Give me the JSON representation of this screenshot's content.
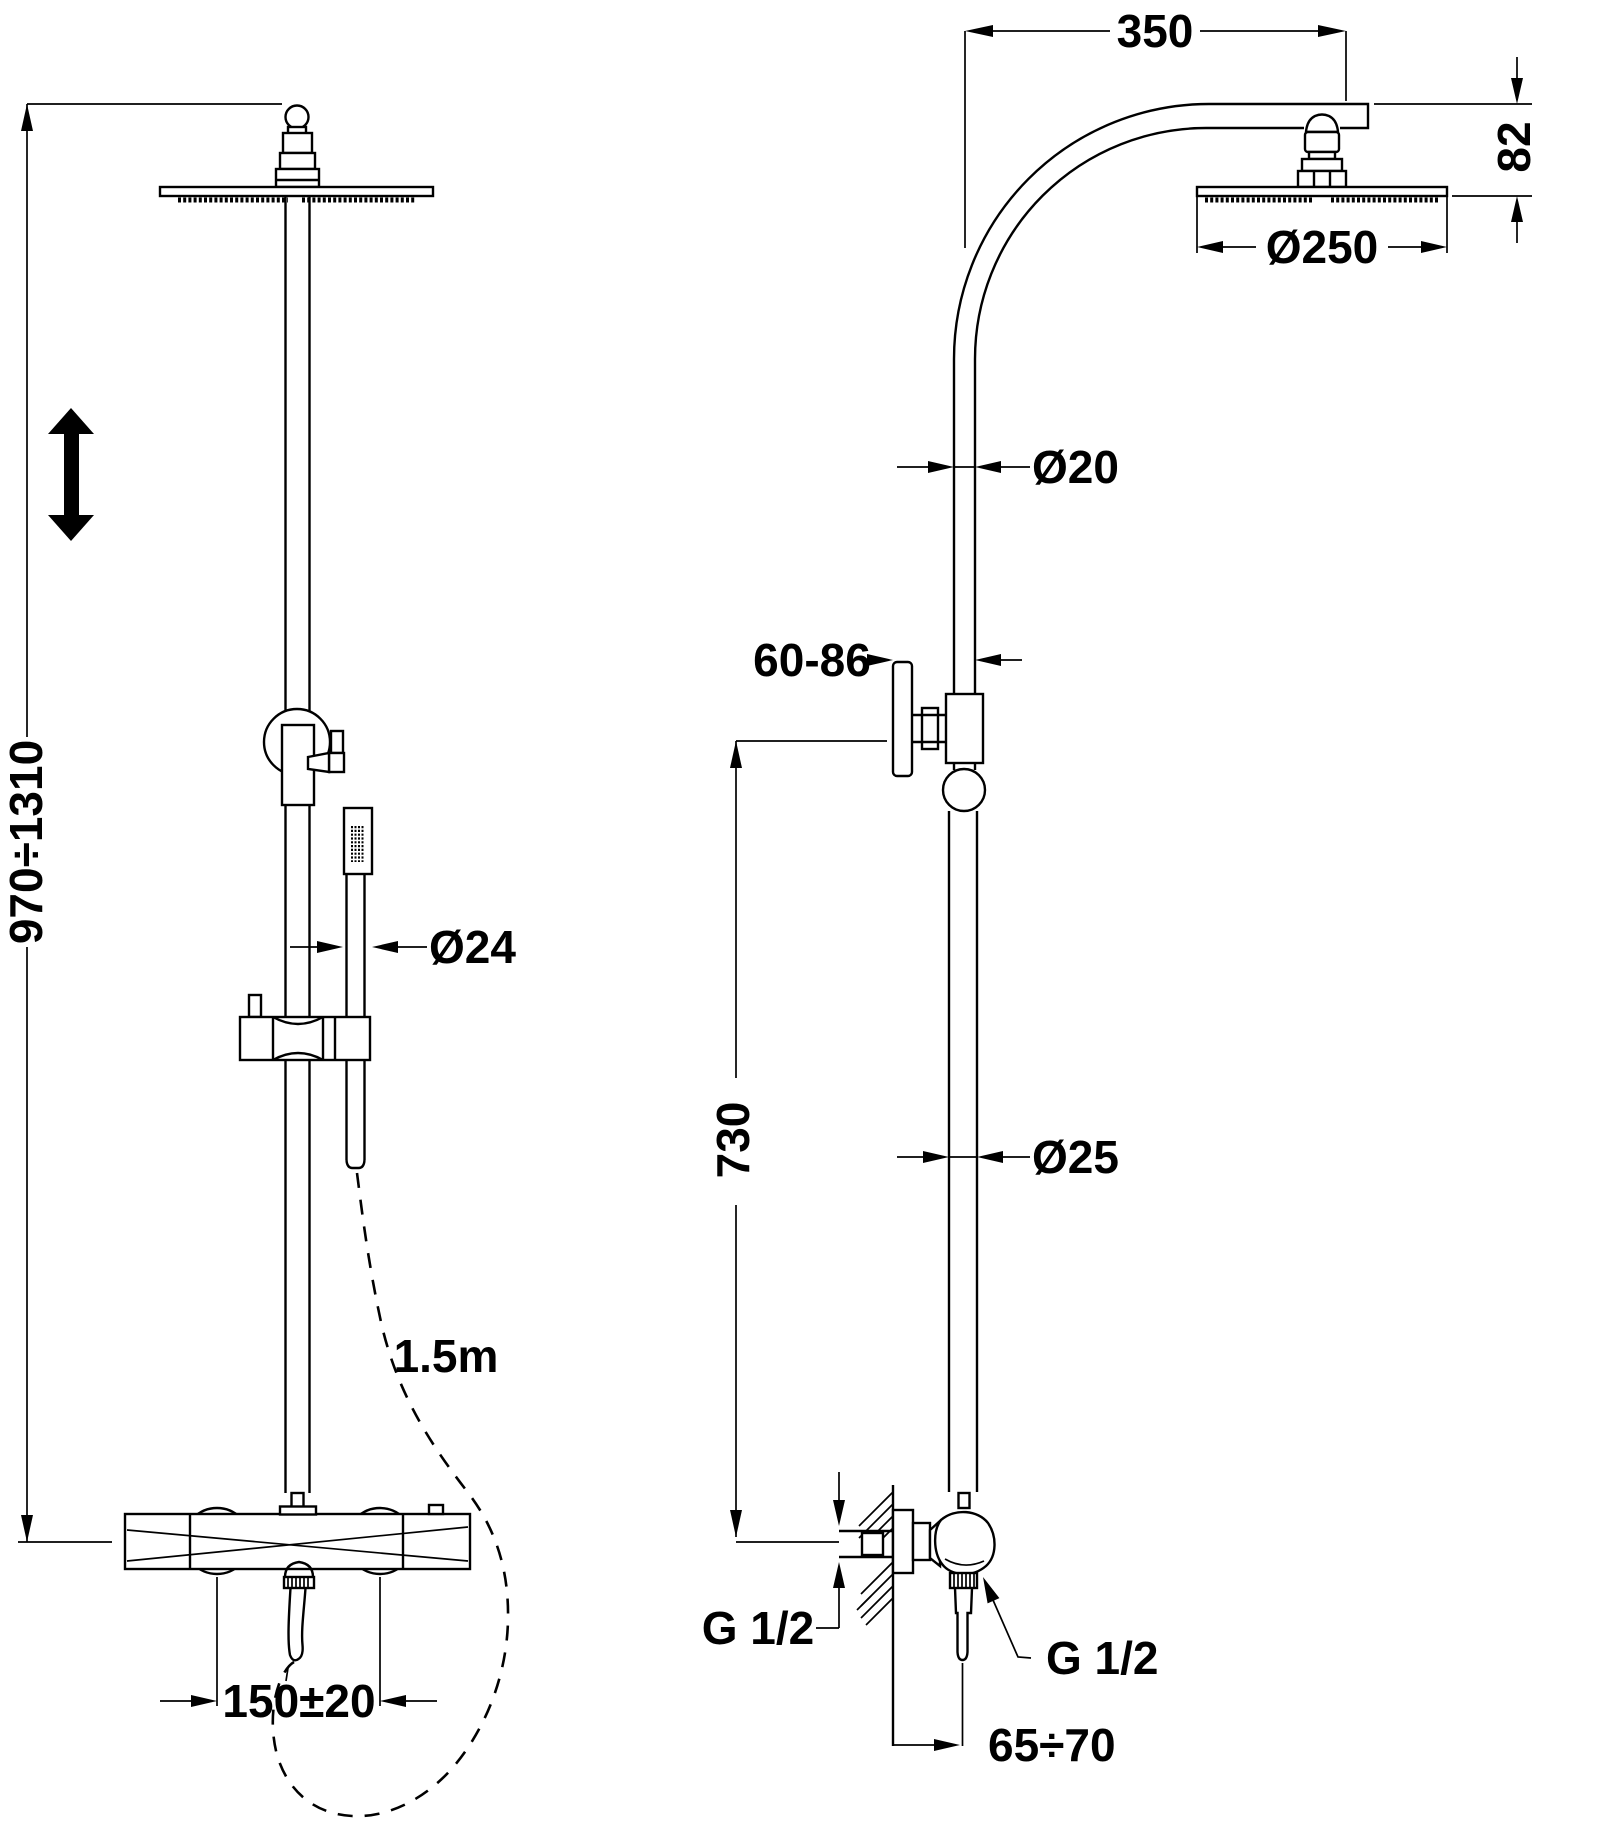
{
  "drawing": {
    "background_color": "#ffffff",
    "line_color": "#000000",
    "labels": {
      "front": {
        "height_range": "970÷1310",
        "handshower_diameter": "Ø24",
        "hose_length": "1.5m",
        "connection_spacing": "150±20"
      },
      "side": {
        "arm_projection": "350",
        "head_height": "82",
        "head_diameter": "Ø250",
        "upper_pipe_diameter": "Ø20",
        "wall_clearance": "60-86",
        "bracket_height": "730",
        "lower_pipe_diameter": "Ø25",
        "inlet_thread": "G 1/2",
        "outlet_thread": "G 1/2",
        "wall_to_outlet": "65÷70"
      }
    }
  }
}
